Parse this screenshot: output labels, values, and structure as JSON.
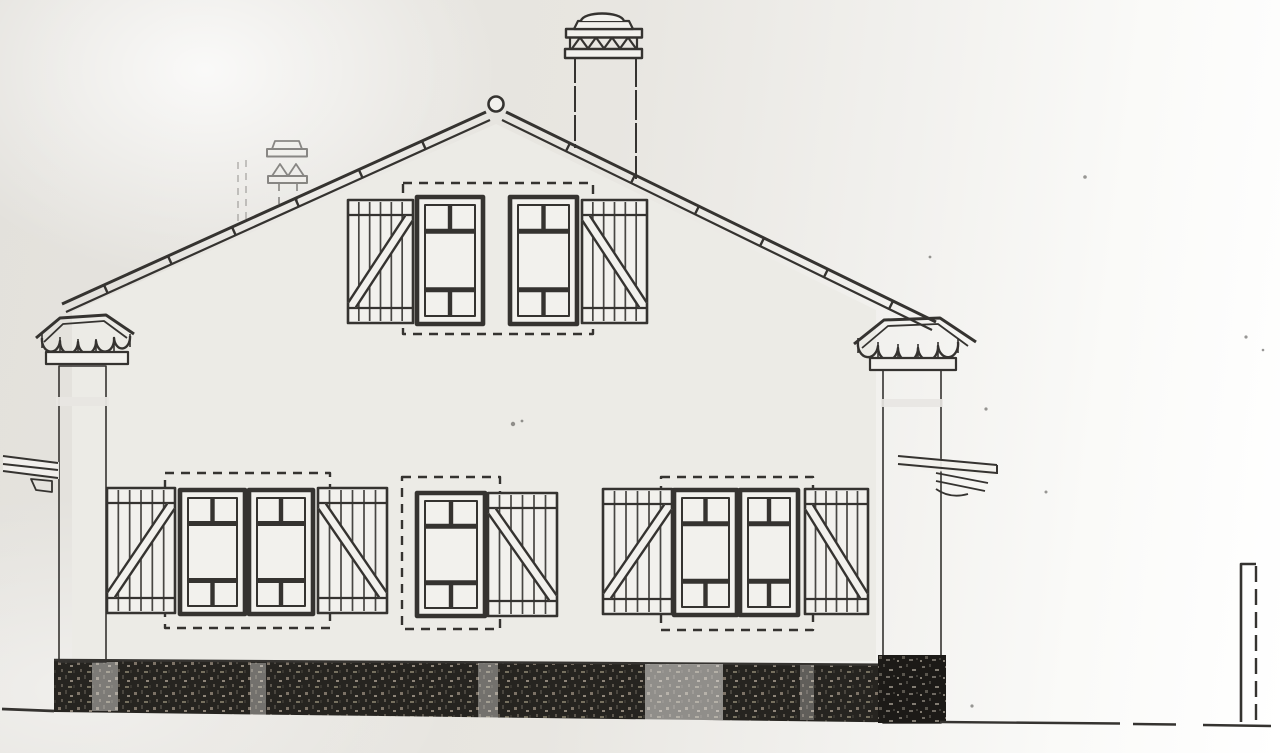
{
  "drawing": {
    "kind": "scanned architectural elevation drawing of a house",
    "labels": {
      "page": "photocopied elevation drawing",
      "wall": "gable-end wall",
      "roof": "gable roof with ridge tiles and round finial",
      "chimney_main": "main chimney with triangle-frieze cap",
      "chimney_secondary": "small secondary chimney behind roof",
      "pier_left": "left masonry pier with tiled cap",
      "pier_right": "right masonry pier with tiled cap",
      "beam_left": "projecting beam at left pier",
      "spout_right": "projecting spout beams at right pier",
      "window_gable": "gable window, two casements with board shutters",
      "window_lower_left": "lower left window, two casements with board shutters",
      "window_lower_middle": "small middle window with single board shutter",
      "window_lower_right": "lower right window, two casements with board shutters",
      "foundation": "dark stone foundation band",
      "ground": "ground line",
      "post": "thin post at far right",
      "specks": "photocopy specks"
    },
    "counts": {
      "windows": 4,
      "window_leaves": 7,
      "shutters": 7,
      "chimneys": 2,
      "piers": 2
    },
    "colors": {
      "paper": "#e8e6e2",
      "paper_light": "#f2f1ed",
      "ink": "#353330",
      "masonry": "#1c1a17",
      "pier_gray": "#57534a"
    }
  }
}
